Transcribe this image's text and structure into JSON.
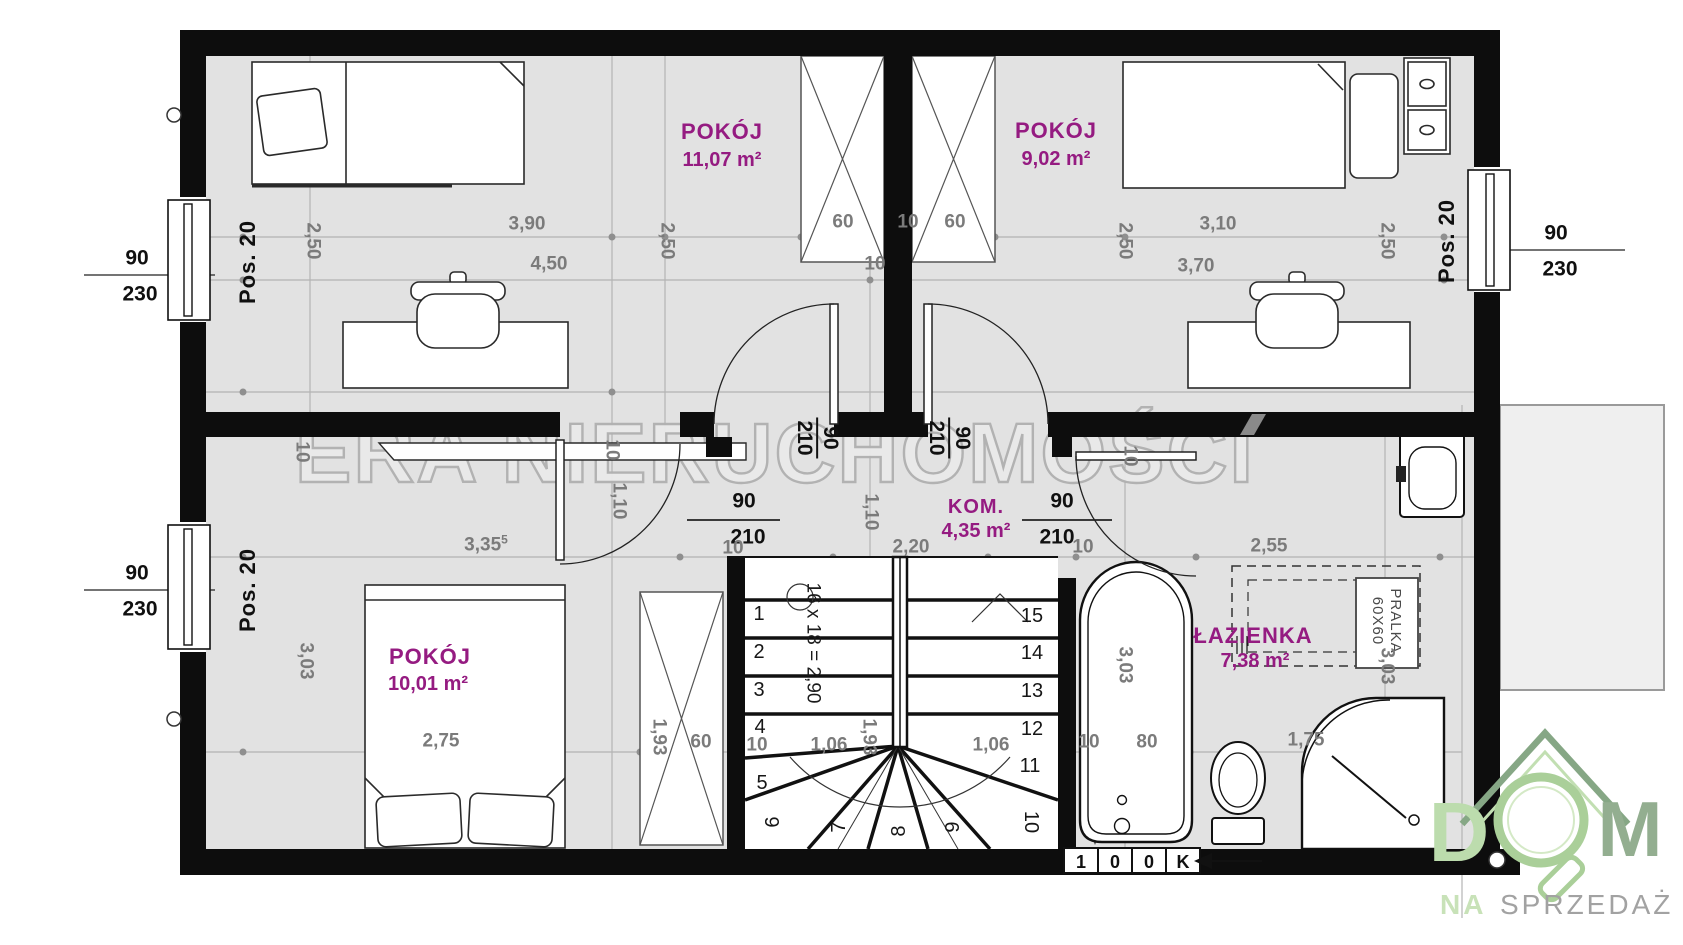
{
  "watermark": "ERA NIERUCHOMOŚCI",
  "colors": {
    "wall": "#0d0d0d",
    "floor": "#e2e2e2",
    "room_label": "#951b81",
    "dim_gray": "#7b7b7b",
    "logo_green_light": "#b7d8a7",
    "logo_green_dark": "#8fae8c",
    "logo_gray": "#a2a2a2"
  },
  "rooms": [
    {
      "name": "POKÓJ",
      "area": "11,07 m²"
    },
    {
      "name": "POKÓJ",
      "area": "9,02 m²"
    },
    {
      "name": "KOM.",
      "area": "4,35 m²"
    },
    {
      "name": "POKÓJ",
      "area": "10,01 m²"
    },
    {
      "name": "ŁAZIENKA",
      "area": "7,38 m²"
    }
  ],
  "windows": [
    {
      "num": "90",
      "den": "230",
      "pos": "Pos. 20"
    },
    {
      "num": "90",
      "den": "230",
      "pos": "Pos. 20"
    },
    {
      "num": "90",
      "den": "230",
      "pos": "Pos. 20"
    }
  ],
  "doors": [
    {
      "num": "90",
      "den": "210"
    },
    {
      "num": "90",
      "den": "210"
    },
    {
      "num": "90",
      "den": "210"
    },
    {
      "num": "90",
      "den": "210"
    }
  ],
  "stairs": {
    "note": "16 x 18 = 2,90",
    "steps": [
      {
        "n": "1",
        "x": 759,
        "y": 614,
        "r": 0
      },
      {
        "n": "2",
        "x": 759,
        "y": 652,
        "r": 0
      },
      {
        "n": "3",
        "x": 759,
        "y": 690,
        "r": 0
      },
      {
        "n": "4",
        "x": 760,
        "y": 727,
        "r": 0
      },
      {
        "n": "5",
        "x": 762,
        "y": 783,
        "r": 0
      },
      {
        "n": "6",
        "x": 773,
        "y": 822,
        "r": -90
      },
      {
        "n": "7",
        "x": 839,
        "y": 827,
        "r": -90
      },
      {
        "n": "8",
        "x": 899,
        "y": 831,
        "r": -90
      },
      {
        "n": "9",
        "x": 953,
        "y": 827,
        "r": -90
      },
      {
        "n": "10",
        "x": 1031,
        "y": 822,
        "r": 90
      },
      {
        "n": "11",
        "x": 1030,
        "y": 766,
        "r": 0
      },
      {
        "n": "12",
        "x": 1032,
        "y": 729,
        "r": 0
      },
      {
        "n": "13",
        "x": 1032,
        "y": 691,
        "r": 0
      },
      {
        "n": "14",
        "x": 1032,
        "y": 653,
        "r": 0
      },
      {
        "n": "15",
        "x": 1032,
        "y": 616,
        "r": 0
      }
    ]
  },
  "dims": [
    {
      "t": "2,50",
      "x": 313,
      "y": 241,
      "r": 90
    },
    {
      "t": "3,90",
      "x": 527,
      "y": 224,
      "r": 0
    },
    {
      "t": "2,50",
      "x": 667,
      "y": 241,
      "r": 90
    },
    {
      "t": "60",
      "x": 843,
      "y": 222,
      "r": 0
    },
    {
      "t": "10",
      "x": 908,
      "y": 222,
      "r": 0
    },
    {
      "t": "60",
      "x": 955,
      "y": 222,
      "r": 0
    },
    {
      "t": "2,50",
      "x": 1125,
      "y": 241,
      "r": 90
    },
    {
      "t": "3,10",
      "x": 1218,
      "y": 224,
      "r": 0
    },
    {
      "t": "2,50",
      "x": 1387,
      "y": 241,
      "r": 90
    },
    {
      "t": "4,50",
      "x": 549,
      "y": 264,
      "r": 0
    },
    {
      "t": "10",
      "x": 875,
      "y": 264,
      "r": 0
    },
    {
      "t": "3,70",
      "x": 1196,
      "y": 266,
      "r": 0
    },
    {
      "t": "3,35",
      "sup": "5",
      "x": 486,
      "y": 544,
      "r": 0
    },
    {
      "t": "10",
      "x": 733,
      "y": 548,
      "r": 0
    },
    {
      "t": "2,20",
      "x": 911,
      "y": 547,
      "r": 0
    },
    {
      "t": "10",
      "x": 1083,
      "y": 547,
      "r": 0
    },
    {
      "t": "2,55",
      "x": 1269,
      "y": 546,
      "r": 0
    },
    {
      "t": "10",
      "x": 302,
      "y": 452,
      "r": 90
    },
    {
      "t": "10",
      "x": 612,
      "y": 450,
      "r": 90
    },
    {
      "t": "10",
      "x": 1130,
      "y": 456,
      "r": 90
    },
    {
      "t": "3,03",
      "x": 306,
      "y": 661,
      "r": 90
    },
    {
      "t": "1,10",
      "x": 619,
      "y": 501,
      "r": 90
    },
    {
      "t": "1,10",
      "x": 871,
      "y": 512,
      "r": 90
    },
    {
      "t": "3,03",
      "x": 1125,
      "y": 665,
      "r": 90
    },
    {
      "t": "3,03",
      "x": 1387,
      "y": 666,
      "r": 90
    },
    {
      "t": "2,75",
      "x": 441,
      "y": 741,
      "r": 0
    },
    {
      "t": "1,93",
      "x": 659,
      "y": 737,
      "r": 90
    },
    {
      "t": "60",
      "x": 701,
      "y": 742,
      "r": 0
    },
    {
      "t": "10",
      "x": 757,
      "y": 745,
      "r": 0
    },
    {
      "t": "1,06",
      "x": 829,
      "y": 745,
      "r": 0
    },
    {
      "t": "1,93",
      "x": 869,
      "y": 737,
      "r": 90
    },
    {
      "t": "1,06",
      "x": 991,
      "y": 745,
      "r": 0
    },
    {
      "t": "10",
      "x": 1089,
      "y": 742,
      "r": 0
    },
    {
      "t": "80",
      "x": 1147,
      "y": 742,
      "r": 0
    },
    {
      "t": "1,75",
      "x": 1306,
      "y": 740,
      "r": 0
    }
  ],
  "appliance": {
    "line1": "PRALKA",
    "line2": "60X60"
  },
  "levels": [
    {
      "t": "1",
      "x": 1081,
      "y": 862
    },
    {
      "t": "0",
      "x": 1115,
      "y": 862
    },
    {
      "t": "0",
      "x": 1149,
      "y": 862
    },
    {
      "t": "K",
      "x": 1183,
      "y": 862
    }
  ],
  "logo": {
    "d": "D",
    "m": "M",
    "na": "NA",
    "sprzedaz": "SPRZEDAŻ"
  }
}
